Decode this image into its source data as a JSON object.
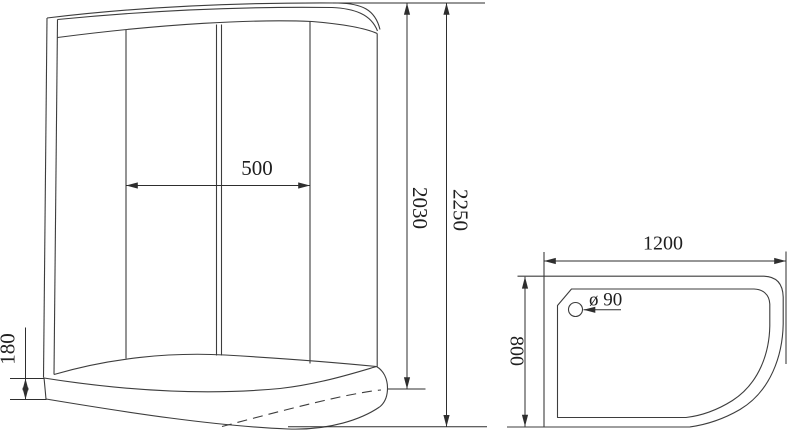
{
  "drawing": {
    "front_view": {
      "dimensions": {
        "door_opening_width": "500",
        "glass_height": "2030",
        "total_height": "2250",
        "tray_height": "180"
      }
    },
    "top_view": {
      "dimensions": {
        "tray_width": "1200",
        "tray_depth": "800",
        "drain_diameter": "ø 90"
      }
    },
    "colors": {
      "line": "#3d3d3d",
      "dimension_line": "#2e2e2e",
      "text": "#1f1f1f",
      "background": "#ffffff"
    }
  }
}
